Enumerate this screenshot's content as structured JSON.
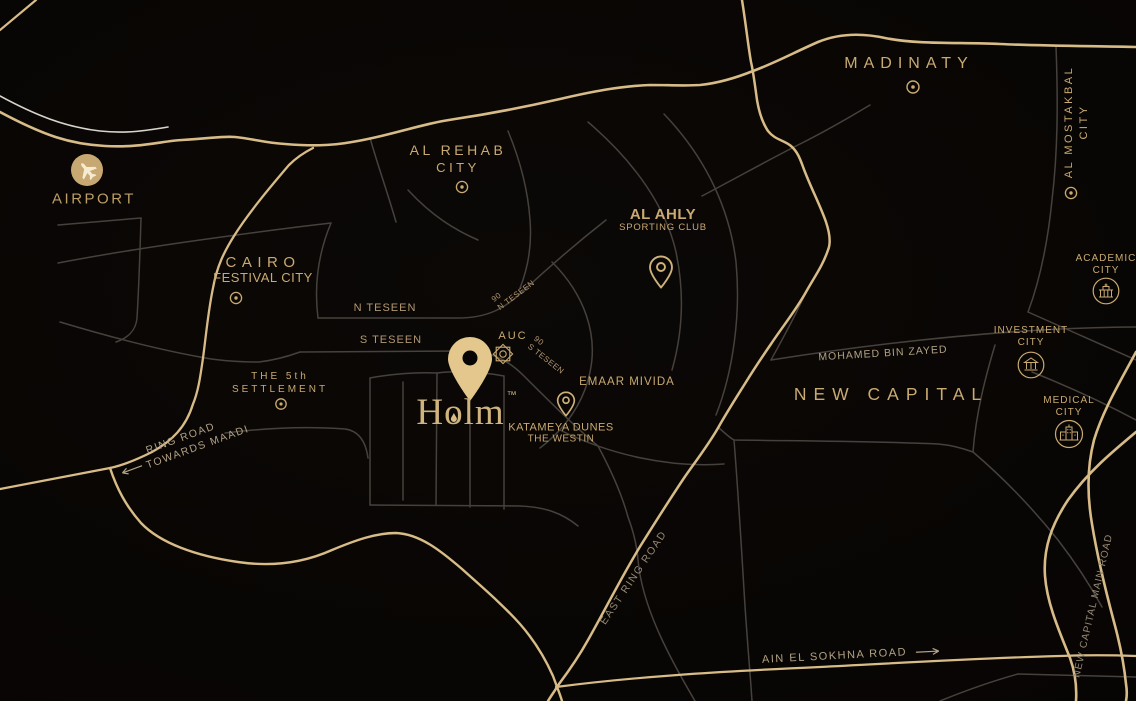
{
  "colors": {
    "background": "#060403",
    "road_gold": "#d8bc88",
    "road_gray": "#46413c",
    "road_light": "#d8d4cc",
    "label_gold": "#c9aa71",
    "label_dim": "#968a74",
    "pin_gold": "#e3c78d"
  },
  "places": {
    "airport": {
      "label": "AIRPORT",
      "icon": "plane-icon"
    },
    "madinaty": {
      "label": "MADINATY",
      "marker": "circle-dot"
    },
    "al_mostakbal_city": {
      "line1": "AL MOSTAKBAL",
      "line2": "CITY",
      "marker": "circle-dot"
    },
    "al_rehab_city": {
      "line1": "AL REHAB",
      "line2": "CITY",
      "marker": "circle-dot"
    },
    "al_ahly": {
      "line1": "AL AHLY",
      "line2": "SPORTING CLUB",
      "marker": "pin-outline"
    },
    "cairo_festival_city": {
      "line1": "CAIRO",
      "line2": "FESTIVAL CITY",
      "marker": "circle-dot"
    },
    "the_5th_settlement": {
      "line1": "THE 5th",
      "line2": "SETTLEMENT",
      "marker": "circle-dot"
    },
    "n_teseen": {
      "label": "N TESEEN"
    },
    "s_teseen": {
      "label": "S TESEEN"
    },
    "ninety_n_teseen": {
      "line1": "90",
      "line2": "N TESEEN"
    },
    "ninety_s_teseen": {
      "line1": "90",
      "line2": "S TESEEN"
    },
    "auc": {
      "label": "AUC",
      "icon": "rosette-icon"
    },
    "holm": {
      "wordmark": "Holm",
      "trademark": "™",
      "icon": "pin-filled"
    },
    "katameya_dunes": {
      "line1": "KATAMEYA DUNES",
      "line2": "THE WESTIN",
      "marker": "pin-outline"
    },
    "emaar_mivida": {
      "label": "EMAAR MIVIDA"
    },
    "new_capital": {
      "label": "NEW CAPITAL"
    },
    "mohamed_bin_zayed": {
      "label": "MOHAMED BIN ZAYED"
    },
    "academic_city": {
      "line1": "ACADEMIC",
      "line2": "CITY",
      "icon": "academic-building-icon"
    },
    "investment_city": {
      "line1": "INVESTMENT",
      "line2": "CITY",
      "icon": "bank-building-icon"
    },
    "medical_city": {
      "line1": "MEDICAL",
      "line2": "CITY",
      "icon": "hospital-building-icon"
    },
    "east_ring_road": {
      "label": "EAST RING ROAD"
    },
    "ain_el_sokhna_road": {
      "label": "AIN EL SOKHNA ROAD",
      "arrow": "→"
    },
    "new_capital_main_road": {
      "label": "NEW CAPITAL MAIN ROAD"
    },
    "ring_road_maadi": {
      "line1": "RING ROAD",
      "line2": "TOWARDS MAADI",
      "arrow": "←"
    }
  }
}
